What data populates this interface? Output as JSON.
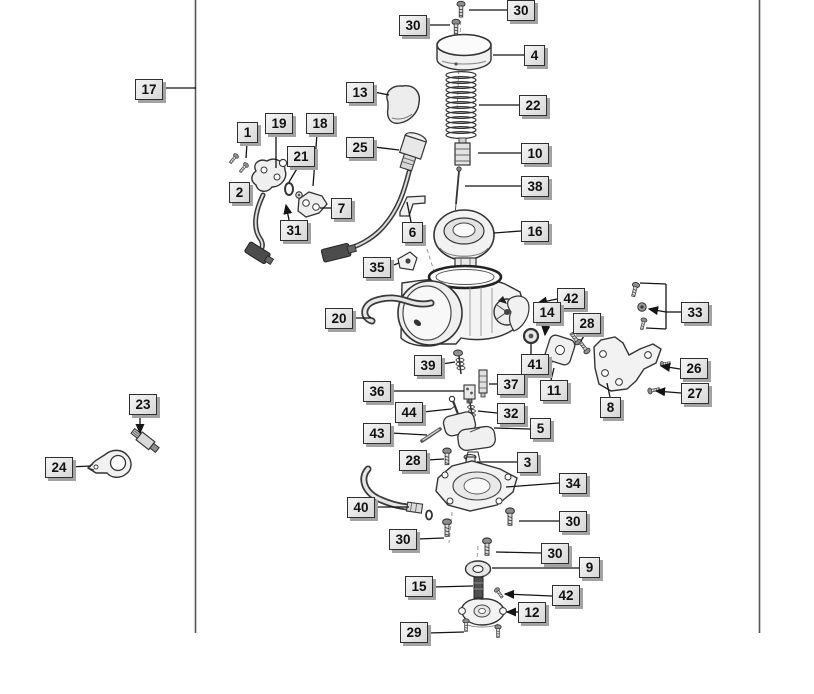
{
  "diagram": {
    "background": "#ffffff",
    "line_color": "#3a3a3a",
    "leader_color": "#141414",
    "label_style": {
      "bg": "#e6e6e6",
      "border": "#2f2f2f",
      "shadow": "#a2a2a2",
      "text": "#111111"
    },
    "frame_lines": [
      {
        "x": 195.5,
        "y1": 0,
        "y2": 633
      },
      {
        "x": 759.5,
        "y1": 0,
        "y2": 633
      }
    ],
    "callouts": [
      {
        "text": "30",
        "x": 507,
        "y": 0,
        "leaders": [
          {
            "points": [
              [
                507,
                10
              ],
              [
                469,
                10
              ]
            ]
          }
        ]
      },
      {
        "text": "30",
        "x": 399,
        "y": 15,
        "leaders": [
          {
            "points": [
              [
                427,
                25
              ],
              [
                450,
                25
              ]
            ]
          }
        ]
      },
      {
        "text": "4",
        "x": 524,
        "y": 45,
        "leaders": [
          {
            "points": [
              [
                524,
                55
              ],
              [
                493,
                55
              ]
            ]
          }
        ]
      },
      {
        "text": "22",
        "x": 519,
        "y": 95,
        "leaders": [
          {
            "points": [
              [
                519,
                105
              ],
              [
                479,
                105
              ]
            ]
          }
        ]
      },
      {
        "text": "17",
        "x": 135,
        "y": 79,
        "leaders": [
          {
            "points": [
              [
                163,
                88
              ],
              [
                196,
                88
              ]
            ]
          }
        ]
      },
      {
        "text": "13",
        "x": 346,
        "y": 82,
        "leaders": [
          {
            "points": [
              [
                374,
                92
              ],
              [
                389,
                95
              ]
            ]
          }
        ]
      },
      {
        "text": "1",
        "x": 237,
        "y": 122,
        "leaders": [
          {
            "points": [
              [
                247,
                143
              ],
              [
                246,
                158
              ]
            ]
          }
        ]
      },
      {
        "text": "19",
        "x": 265,
        "y": 113,
        "leaders": [
          {
            "points": [
              [
                276,
                134
              ],
              [
                276,
                168
              ]
            ]
          }
        ]
      },
      {
        "text": "18",
        "x": 306,
        "y": 113,
        "leaders": [
          {
            "points": [
              [
                317,
                134
              ],
              [
                313,
                186
              ]
            ]
          }
        ]
      },
      {
        "text": "21",
        "x": 287,
        "y": 146,
        "leaders": [
          {
            "points": [
              [
                298,
                167
              ],
              [
                289,
                182
              ]
            ]
          }
        ]
      },
      {
        "text": "25",
        "x": 346,
        "y": 137,
        "leaders": [
          {
            "points": [
              [
                374,
                147
              ],
              [
                399,
                150
              ]
            ]
          }
        ]
      },
      {
        "text": "2",
        "x": 229,
        "y": 182,
        "leaders": []
      },
      {
        "text": "7",
        "x": 331,
        "y": 198,
        "leaders": [
          {
            "points": [
              [
                331,
                208
              ],
              [
                320,
                208
              ]
            ]
          }
        ]
      },
      {
        "text": "31",
        "x": 280,
        "y": 220,
        "leaders": [
          {
            "points": [
              [
                289,
                220
              ],
              [
                286,
                205
              ]
            ],
            "arrow": true
          }
        ]
      },
      {
        "text": "6",
        "x": 402,
        "y": 222,
        "leaders": [
          {
            "points": [
              [
                411,
                222
              ],
              [
                407,
                202
              ]
            ]
          }
        ]
      },
      {
        "text": "10",
        "x": 521,
        "y": 143,
        "leaders": [
          {
            "points": [
              [
                521,
                153
              ],
              [
                478,
                153
              ]
            ]
          }
        ]
      },
      {
        "text": "38",
        "x": 521,
        "y": 176,
        "leaders": [
          {
            "points": [
              [
                521,
                186
              ],
              [
                465,
                186
              ]
            ]
          }
        ]
      },
      {
        "text": "16",
        "x": 521,
        "y": 221,
        "leaders": [
          {
            "points": [
              [
                521,
                231
              ],
              [
                494,
                233
              ]
            ]
          }
        ]
      },
      {
        "text": "35",
        "x": 363,
        "y": 257,
        "leaders": [
          {
            "points": [
              [
                391,
                266
              ],
              [
                399,
                263
              ]
            ]
          }
        ]
      },
      {
        "text": "20",
        "x": 325,
        "y": 308,
        "leaders": [
          {
            "points": [
              [
                353,
                318
              ],
              [
                371,
                318
              ]
            ]
          }
        ]
      },
      {
        "text": "42",
        "x": 557,
        "y": 288,
        "leaders": [
          {
            "points": [
              [
                557,
                299
              ],
              [
                538,
                303
              ]
            ],
            "arrow": true
          }
        ]
      },
      {
        "text": "14",
        "x": 533,
        "y": 302,
        "leaders": [
          {
            "points": [
              [
                546,
                323
              ],
              [
                545,
                335
              ]
            ],
            "arrow": true
          }
        ]
      },
      {
        "text": "28",
        "x": 573,
        "y": 313,
        "leaders": [
          {
            "points": [
              [
                585,
                334
              ],
              [
                581,
                341
              ]
            ]
          }
        ]
      },
      {
        "text": "41",
        "x": 521,
        "y": 354,
        "leaders": [
          {
            "points": [
              [
                531,
                354
              ],
              [
                531,
                344
              ]
            ]
          }
        ]
      },
      {
        "text": "11",
        "x": 540,
        "y": 380,
        "leaders": [
          {
            "points": [
              [
                551,
                380
              ],
              [
                554,
                368
              ]
            ]
          }
        ]
      },
      {
        "text": "37",
        "x": 497,
        "y": 374,
        "leaders": [
          {
            "points": [
              [
                497,
                384
              ],
              [
                489,
                384
              ]
            ]
          }
        ]
      },
      {
        "text": "39",
        "x": 414,
        "y": 355,
        "leaders": [
          {
            "points": [
              [
                442,
                364
              ],
              [
                455,
                362
              ]
            ]
          }
        ]
      },
      {
        "text": "36",
        "x": 363,
        "y": 381,
        "leaders": [
          {
            "points": [
              [
                391,
                391
              ],
              [
                464,
                391
              ]
            ]
          }
        ]
      },
      {
        "text": "44",
        "x": 395,
        "y": 402,
        "leaders": [
          {
            "points": [
              [
                423,
                412
              ],
              [
                451,
                409
              ]
            ]
          }
        ]
      },
      {
        "text": "32",
        "x": 497,
        "y": 403,
        "leaders": [
          {
            "points": [
              [
                497,
                413
              ],
              [
                478,
                411
              ]
            ]
          }
        ]
      },
      {
        "text": "43",
        "x": 363,
        "y": 423,
        "leaders": [
          {
            "points": [
              [
                391,
                433
              ],
              [
                427,
                435
              ]
            ]
          }
        ]
      },
      {
        "text": "5",
        "x": 530,
        "y": 418,
        "leaders": [
          {
            "points": [
              [
                530,
                429
              ],
              [
                494,
                428
              ]
            ]
          }
        ]
      },
      {
        "text": "28",
        "x": 399,
        "y": 450,
        "leaders": [
          {
            "points": [
              [
                427,
                460
              ],
              [
                444,
                459
              ]
            ]
          }
        ]
      },
      {
        "text": "3",
        "x": 517,
        "y": 452,
        "leaders": [
          {
            "points": [
              [
                517,
                462
              ],
              [
                477,
                462
              ]
            ]
          }
        ]
      },
      {
        "text": "34",
        "x": 559,
        "y": 473,
        "leaders": [
          {
            "points": [
              [
                559,
                483
              ],
              [
                506,
                487
              ]
            ]
          }
        ]
      },
      {
        "text": "40",
        "x": 347,
        "y": 497,
        "leaders": [
          {
            "points": [
              [
                375,
                507
              ],
              [
                409,
                507
              ]
            ]
          }
        ]
      },
      {
        "text": "30",
        "x": 389,
        "y": 529,
        "leaders": [
          {
            "points": [
              [
                417,
                539
              ],
              [
                444,
                538
              ]
            ]
          }
        ]
      },
      {
        "text": "30",
        "x": 559,
        "y": 511,
        "leaders": [
          {
            "points": [
              [
                559,
                521
              ],
              [
                519,
                521
              ]
            ]
          }
        ]
      },
      {
        "text": "30",
        "x": 541,
        "y": 543,
        "leaders": [
          {
            "points": [
              [
                541,
                553
              ],
              [
                496,
                552
              ]
            ]
          }
        ]
      },
      {
        "text": "9",
        "x": 579,
        "y": 557,
        "leaders": [
          {
            "points": [
              [
                579,
                568
              ],
              [
                492,
                568
              ]
            ]
          }
        ]
      },
      {
        "text": "15",
        "x": 405,
        "y": 576,
        "leaders": [
          {
            "points": [
              [
                433,
                587
              ],
              [
                473,
                586
              ]
            ]
          }
        ]
      },
      {
        "text": "42",
        "x": 552,
        "y": 585,
        "leaders": [
          {
            "points": [
              [
                552,
                596
              ],
              [
                505,
                594
              ]
            ],
            "arrow": true
          }
        ]
      },
      {
        "text": "12",
        "x": 518,
        "y": 602,
        "leaders": [
          {
            "points": [
              [
                518,
                612
              ],
              [
                507,
                612
              ]
            ],
            "arrow": true
          }
        ]
      },
      {
        "text": "29",
        "x": 400,
        "y": 622,
        "leaders": [
          {
            "points": [
              [
                428,
                633
              ],
              [
                464,
                632
              ]
            ]
          }
        ]
      },
      {
        "text": "23",
        "x": 129,
        "y": 394,
        "leaders": [
          {
            "points": [
              [
                140,
                415
              ],
              [
                140,
                433
              ]
            ],
            "arrow": true
          }
        ]
      },
      {
        "text": "24",
        "x": 45,
        "y": 457,
        "leaders": [
          {
            "points": [
              [
                69,
                467
              ],
              [
                91,
                466
              ]
            ]
          }
        ]
      },
      {
        "text": "8",
        "x": 600,
        "y": 397,
        "leaders": [
          {
            "points": [
              [
                610,
                397
              ],
              [
                607,
                383
              ]
            ]
          }
        ]
      },
      {
        "text": "33",
        "x": 681,
        "y": 302,
        "leaders": [
          {
            "points": [
              [
                681,
                312
              ],
              [
                666,
                312
              ]
            ]
          },
          {
            "points": [
              [
                666,
                284
              ],
              [
                666,
                329
              ]
            ]
          },
          {
            "points": [
              [
                666,
                284
              ],
              [
                640,
                283
              ]
            ]
          },
          {
            "points": [
              [
                666,
                329
              ],
              [
                646,
                328
              ]
            ]
          },
          {
            "points": [
              [
                666,
                312
              ],
              [
                649,
                309
              ]
            ],
            "arrow": true
          }
        ]
      },
      {
        "text": "26",
        "x": 680,
        "y": 358,
        "leaders": [
          {
            "points": [
              [
                680,
                369
              ],
              [
                661,
                366
              ]
            ],
            "arrow": true
          }
        ]
      },
      {
        "text": "27",
        "x": 681,
        "y": 383,
        "leaders": [
          {
            "points": [
              [
                681,
                393
              ],
              [
                656,
                391
              ]
            ],
            "arrow": true
          }
        ]
      }
    ]
  }
}
